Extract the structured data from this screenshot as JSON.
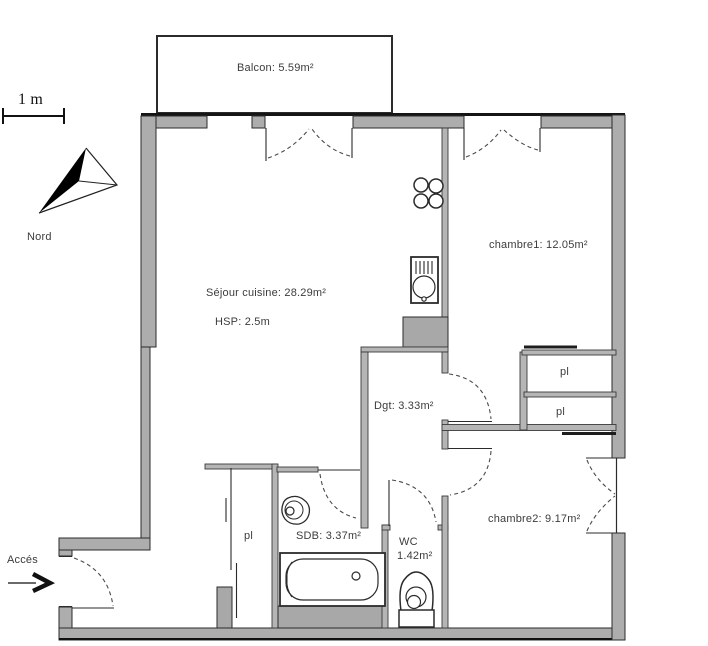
{
  "floorplan": {
    "scale": {
      "label": "1 m"
    },
    "compass": {
      "label": "Nord"
    },
    "access": {
      "label": "Accés"
    },
    "rooms": {
      "balcony": {
        "label": "Balcon: 5.59m²"
      },
      "living": {
        "label": "Séjour cuisine: 28.29m²",
        "ceiling": "HSP: 2.5m"
      },
      "bedroom1": {
        "label": "chambre1: 12.05m²"
      },
      "bedroom2": {
        "label": "chambre2: 9.17m²"
      },
      "hallway": {
        "label": "Dgt: 3.33m²"
      },
      "bathroom": {
        "label": "SDB: 3.37m²"
      },
      "toilet": {
        "label": "WC",
        "area": "1.42m²"
      },
      "closet1": {
        "label": "pl"
      },
      "closet2": {
        "label": "pl"
      },
      "closet_entry": {
        "label": "pl"
      }
    },
    "colors": {
      "wall": "#adadad",
      "edge": "#2b2b2b",
      "background": "#ffffff"
    }
  }
}
